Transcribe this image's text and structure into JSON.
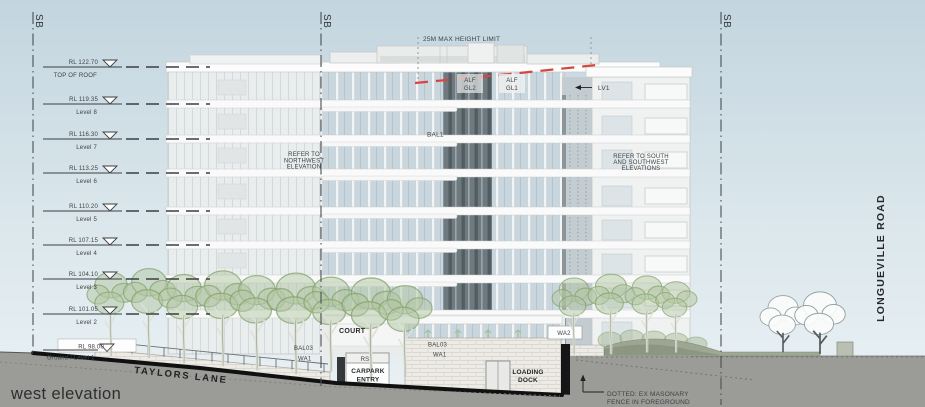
{
  "drawing": {
    "title": "west elevation",
    "section_break_label": "SB",
    "height_limit_label": "25M MAX HEIGHT LIMIT"
  },
  "levels": [
    {
      "rl": "RL 122.70",
      "name": "TOP OF ROOF"
    },
    {
      "rl": "RL 119.35",
      "name": "Level 8"
    },
    {
      "rl": "RL 116.30",
      "name": "Level 7"
    },
    {
      "rl": "RL 113.25",
      "name": "Level 6"
    },
    {
      "rl": "RL 110.20",
      "name": "Level 5"
    },
    {
      "rl": "RL 107.15",
      "name": "Level 4"
    },
    {
      "rl": "RL 104.10",
      "name": "Level 3"
    },
    {
      "rl": "RL 101.05",
      "name": "Level 2"
    },
    {
      "rl": "RL 98.00",
      "name": "Ground / Level 1"
    }
  ],
  "facade_labels": {
    "refer_northwest": [
      "REFER TO",
      "NORTHWEST",
      "ELEVATION"
    ],
    "refer_southwest": [
      "REFER TO SOUTH",
      "AND SOUTHWEST",
      "ELEVATIONS"
    ],
    "bal1": "BAL1",
    "alf_gl2": [
      "ALF",
      "GL2"
    ],
    "alf_gl1": [
      "ALF",
      "GL1"
    ],
    "lv1": "LV1"
  },
  "ground_labels": {
    "court": "COURT",
    "bal03_left": "BAL03",
    "wa1_left": "WA1",
    "rs": "RS",
    "carpark_entry": [
      "CARPARK",
      "ENTRY"
    ],
    "bal03_mid": "BAL03",
    "wa1_mid": "WA1",
    "loading_dock": [
      "LOADING",
      "DOCK"
    ],
    "wa2": "WA2"
  },
  "streets": {
    "taylors_lane": "TAYLORS LANE",
    "longueville_road": "LONGUEVILLE ROAD"
  },
  "notes": {
    "fence_note": [
      "DOTTED: EX MASONARY",
      "FENCE IN FOREGROUND"
    ]
  },
  "colors": {
    "sky_top": "#c3d5df",
    "sky_bottom": "#eaf1f4",
    "ground_gray": "#9b9c98",
    "road_line": "#101010",
    "height_limit_red": "#d8453e",
    "tree_green": "#b2c6a2",
    "annotation_ink": "#3d4245"
  }
}
